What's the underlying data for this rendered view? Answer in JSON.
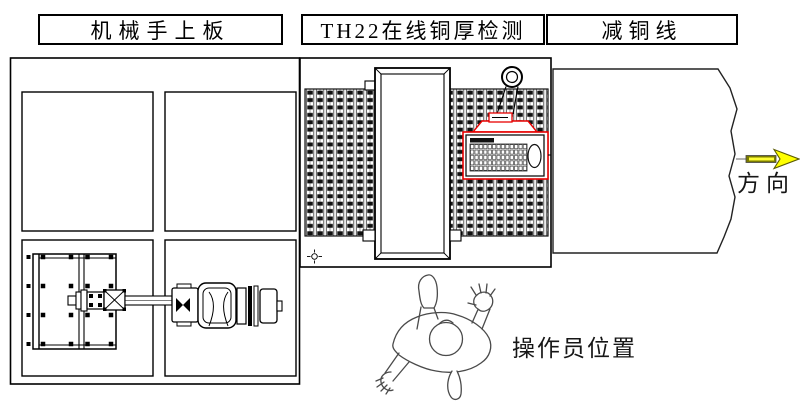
{
  "header": {
    "cells": [
      {
        "label": "机械手上板"
      },
      {
        "label": "TH22在线铜厚检测"
      },
      {
        "label": "减铜线"
      }
    ]
  },
  "annotations": {
    "direction_label": "方向",
    "operator_label": "操作员位置"
  },
  "colors": {
    "line": "#000000",
    "highlight_red": "#e80000",
    "arrow_yellow": "#ffff00",
    "arrow_shaft": "#7a7a00",
    "figure_gray": "#4a4a4a",
    "pattern_dark": "#111111"
  },
  "icons": {
    "lifting_hook": "lifting-hook-icon",
    "datum_mark": "datum-crosshair-icon",
    "direction_arrow": "right-arrow-icon"
  }
}
